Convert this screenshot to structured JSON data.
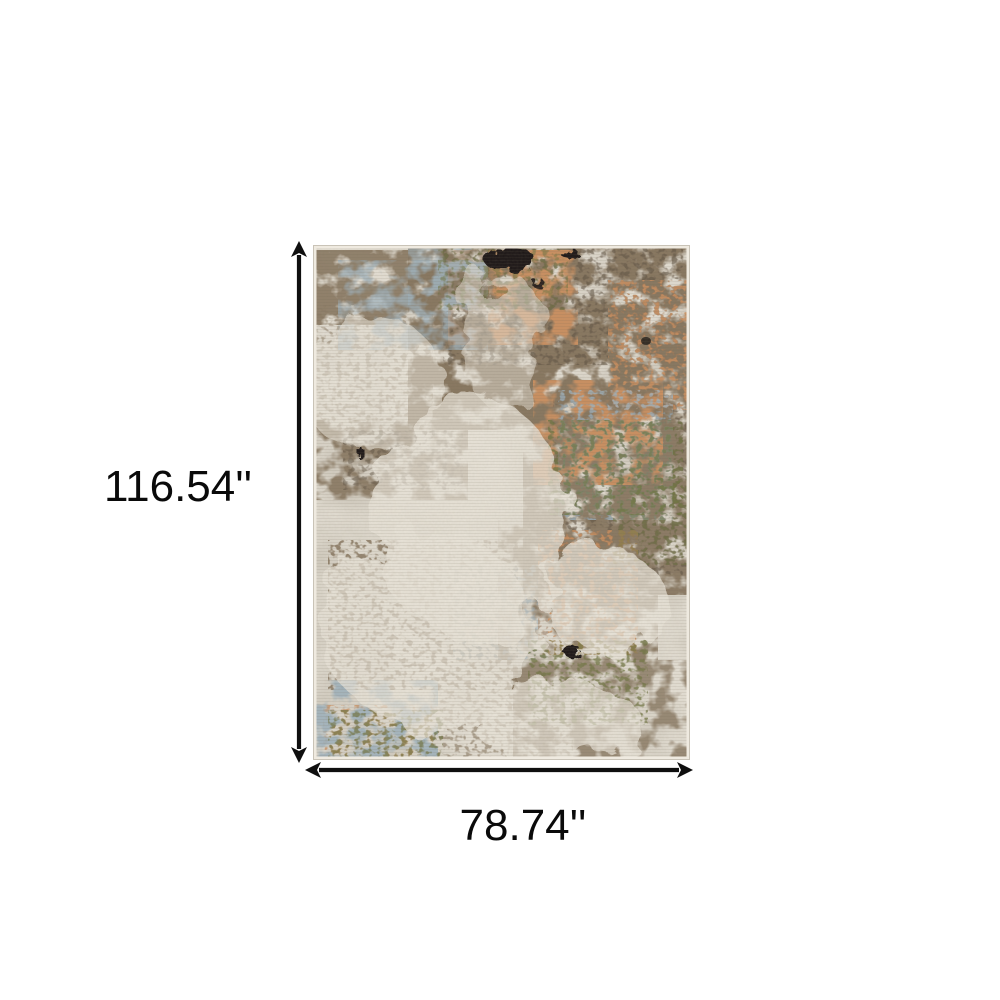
{
  "figure": {
    "height_label": "116.54''",
    "width_label": "78.74''",
    "arrow_color": "#0f0f0f",
    "label_color": "#0a0a0a",
    "background_color": "#ffffff",
    "rug_colors": {
      "base": "#e3ded3",
      "mottle": "#b9b2a4",
      "brown": "#87765f",
      "dark_brown": "#5f5243",
      "copper": "#c98f60",
      "blue_gray": "#9fb2bd",
      "olive": "#6f7442",
      "black": "#1b1813",
      "ivory_highlight": "#eae5da",
      "edge_binding": "#efeae0",
      "outline": "#c9c3b7"
    }
  }
}
